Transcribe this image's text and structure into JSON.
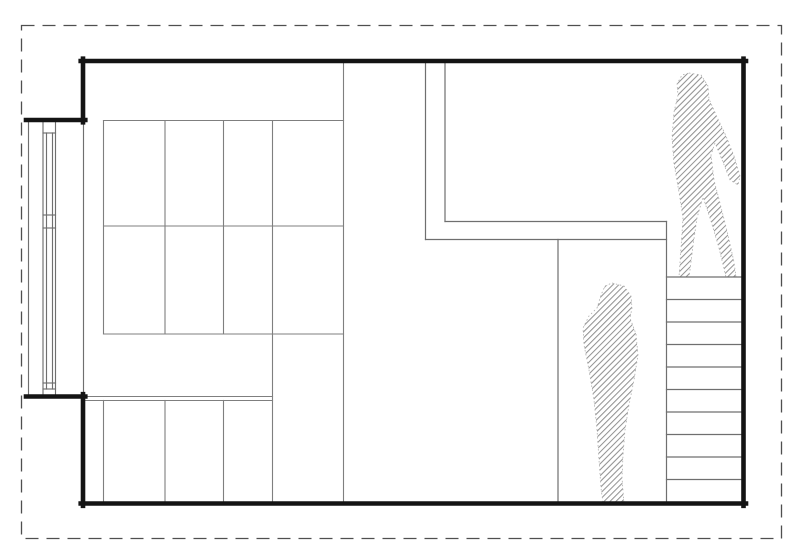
{
  "drawing": {
    "kind": "architectural-section-line-drawing",
    "canvas": {
      "width": 800,
      "height": 550,
      "background": "#ffffff"
    },
    "colors": {
      "wall": "#141414",
      "line": "#6f6f6f",
      "grid": "#7f7f7f",
      "dashed_boundary": "#4f4f4f",
      "hatch": "#909090",
      "figure_edge": "#aeaeae"
    },
    "boundary": {
      "x": 21.5,
      "y": 25.5,
      "width": 760,
      "height": 513,
      "dash": "13 8",
      "width_px": 1.3
    },
    "hatch": {
      "spacing": 4.2,
      "stroke_width": 1.05,
      "angle": -45
    },
    "layers": [
      {
        "name": "window-section-lines",
        "item": "window-line",
        "stroke": "line",
        "width": 1.15,
        "segments": [
          [
            28.5,
            120,
            28.5,
            396
          ],
          [
            43,
            120,
            43,
            396
          ],
          [
            55.5,
            120,
            55.5,
            396
          ],
          [
            46.5,
            133,
            46.5,
            389
          ],
          [
            52.5,
            133,
            52.5,
            389
          ],
          [
            83.5,
            122,
            83.5,
            394.5
          ],
          [
            43,
            133,
            55.5,
            133
          ],
          [
            43,
            215,
            55.5,
            215
          ],
          [
            43,
            228,
            55.5,
            228
          ],
          [
            43,
            383,
            55.5,
            383
          ],
          [
            43,
            389,
            55.5,
            389
          ]
        ]
      },
      {
        "name": "shelving-grid-lines",
        "item": "grid-line",
        "stroke": "grid",
        "width": 1.1,
        "segments": [
          [
            103.5,
            120.5,
            103.5,
            334
          ],
          [
            165,
            120.5,
            165,
            334
          ],
          [
            223.5,
            120.5,
            223.5,
            334
          ],
          [
            272.5,
            120.5,
            272.5,
            503
          ],
          [
            343.5,
            61,
            343.5,
            503
          ],
          [
            103.5,
            120.5,
            343.5,
            120.5
          ],
          [
            103.5,
            226,
            343.5,
            226
          ],
          [
            103.5,
            334,
            343.5,
            334
          ],
          [
            103.5,
            400.5,
            103.5,
            503
          ],
          [
            165,
            400.5,
            165,
            503
          ],
          [
            223.5,
            400.5,
            223.5,
            503
          ],
          [
            85.2,
            396.5,
            272.5,
            396.5
          ],
          [
            85.2,
            400.5,
            272.5,
            400.5
          ]
        ]
      },
      {
        "name": "interior-wall-lines",
        "item": "interior-wall-line",
        "stroke": "line",
        "width": 1.2,
        "segments": [
          [
            425.5,
            61,
            425.5,
            239.5
          ],
          [
            445,
            61,
            445,
            221.5
          ],
          [
            445,
            221.5,
            666.5,
            221.5
          ],
          [
            425.5,
            239.5,
            666.5,
            239.5
          ],
          [
            558,
            239.5,
            558,
            503
          ]
        ]
      },
      {
        "name": "stair-lines",
        "item": "stair-tread-line",
        "stroke": "line",
        "width": 1.2,
        "segments": [
          [
            666.5,
            221.5,
            666.5,
            503
          ],
          [
            666.5,
            277,
            741.3,
            277
          ],
          [
            666.5,
            299.5,
            741.3,
            299.5
          ],
          [
            666.5,
            322,
            741.3,
            322
          ],
          [
            666.5,
            344.5,
            741.3,
            344.5
          ],
          [
            666.5,
            367,
            741.3,
            367
          ],
          [
            666.5,
            389.5,
            741.3,
            389.5
          ],
          [
            666.5,
            412,
            741.3,
            412
          ],
          [
            666.5,
            434.5,
            741.3,
            434.5
          ],
          [
            666.5,
            457,
            741.3,
            457
          ],
          [
            666.5,
            479.5,
            741.3,
            479.5
          ]
        ]
      },
      {
        "name": "outer-walls",
        "item": "wall-line",
        "stroke": "wall",
        "width": 4.6,
        "segments": [
          [
            80.7,
            61,
            746,
            61
          ],
          [
            743.5,
            58.7,
            743.5,
            505.8
          ],
          [
            80.7,
            503.5,
            746,
            503.5
          ],
          [
            83,
            58.7,
            83,
            122.3
          ],
          [
            26,
            120,
            85.3,
            120
          ],
          [
            26,
            396.5,
            85.3,
            396.5
          ],
          [
            83,
            394.2,
            83,
            505.8
          ]
        ]
      }
    ],
    "figures": [
      {
        "name": "person-top-of-stairs",
        "path": "M689,73 L701,75 L708,86 L709,99 L717,117 L726,136 L734,156 L740,176 L738,185 L730,180 L723,162 L715,143 L711,155 L714,180 L721,207 L728,235 L734,262 L736,277 L726,277 L719,248 L711,221 L703,197 L697,218 L693,246 L690,270 L689,277 L679,277 L681,248 L683,218 L679,192 L674,164 L672,138 L674,112 L678,95 L677,84 L682,75 Z"
      },
      {
        "name": "person-standing-lower-room",
        "path": "M612,283 L624,286 L631,296 L632,308 L630,318 L636,334 L638,355 L634,380 L629,405 L625,430 L623,455 L622,478 L624,503 L603,503 L601,488 L599,460 L597,430 L594,400 L589,370 L584,345 L583,328 L589,316 L597,308 L601,295 L605,286 Z"
      }
    ]
  }
}
